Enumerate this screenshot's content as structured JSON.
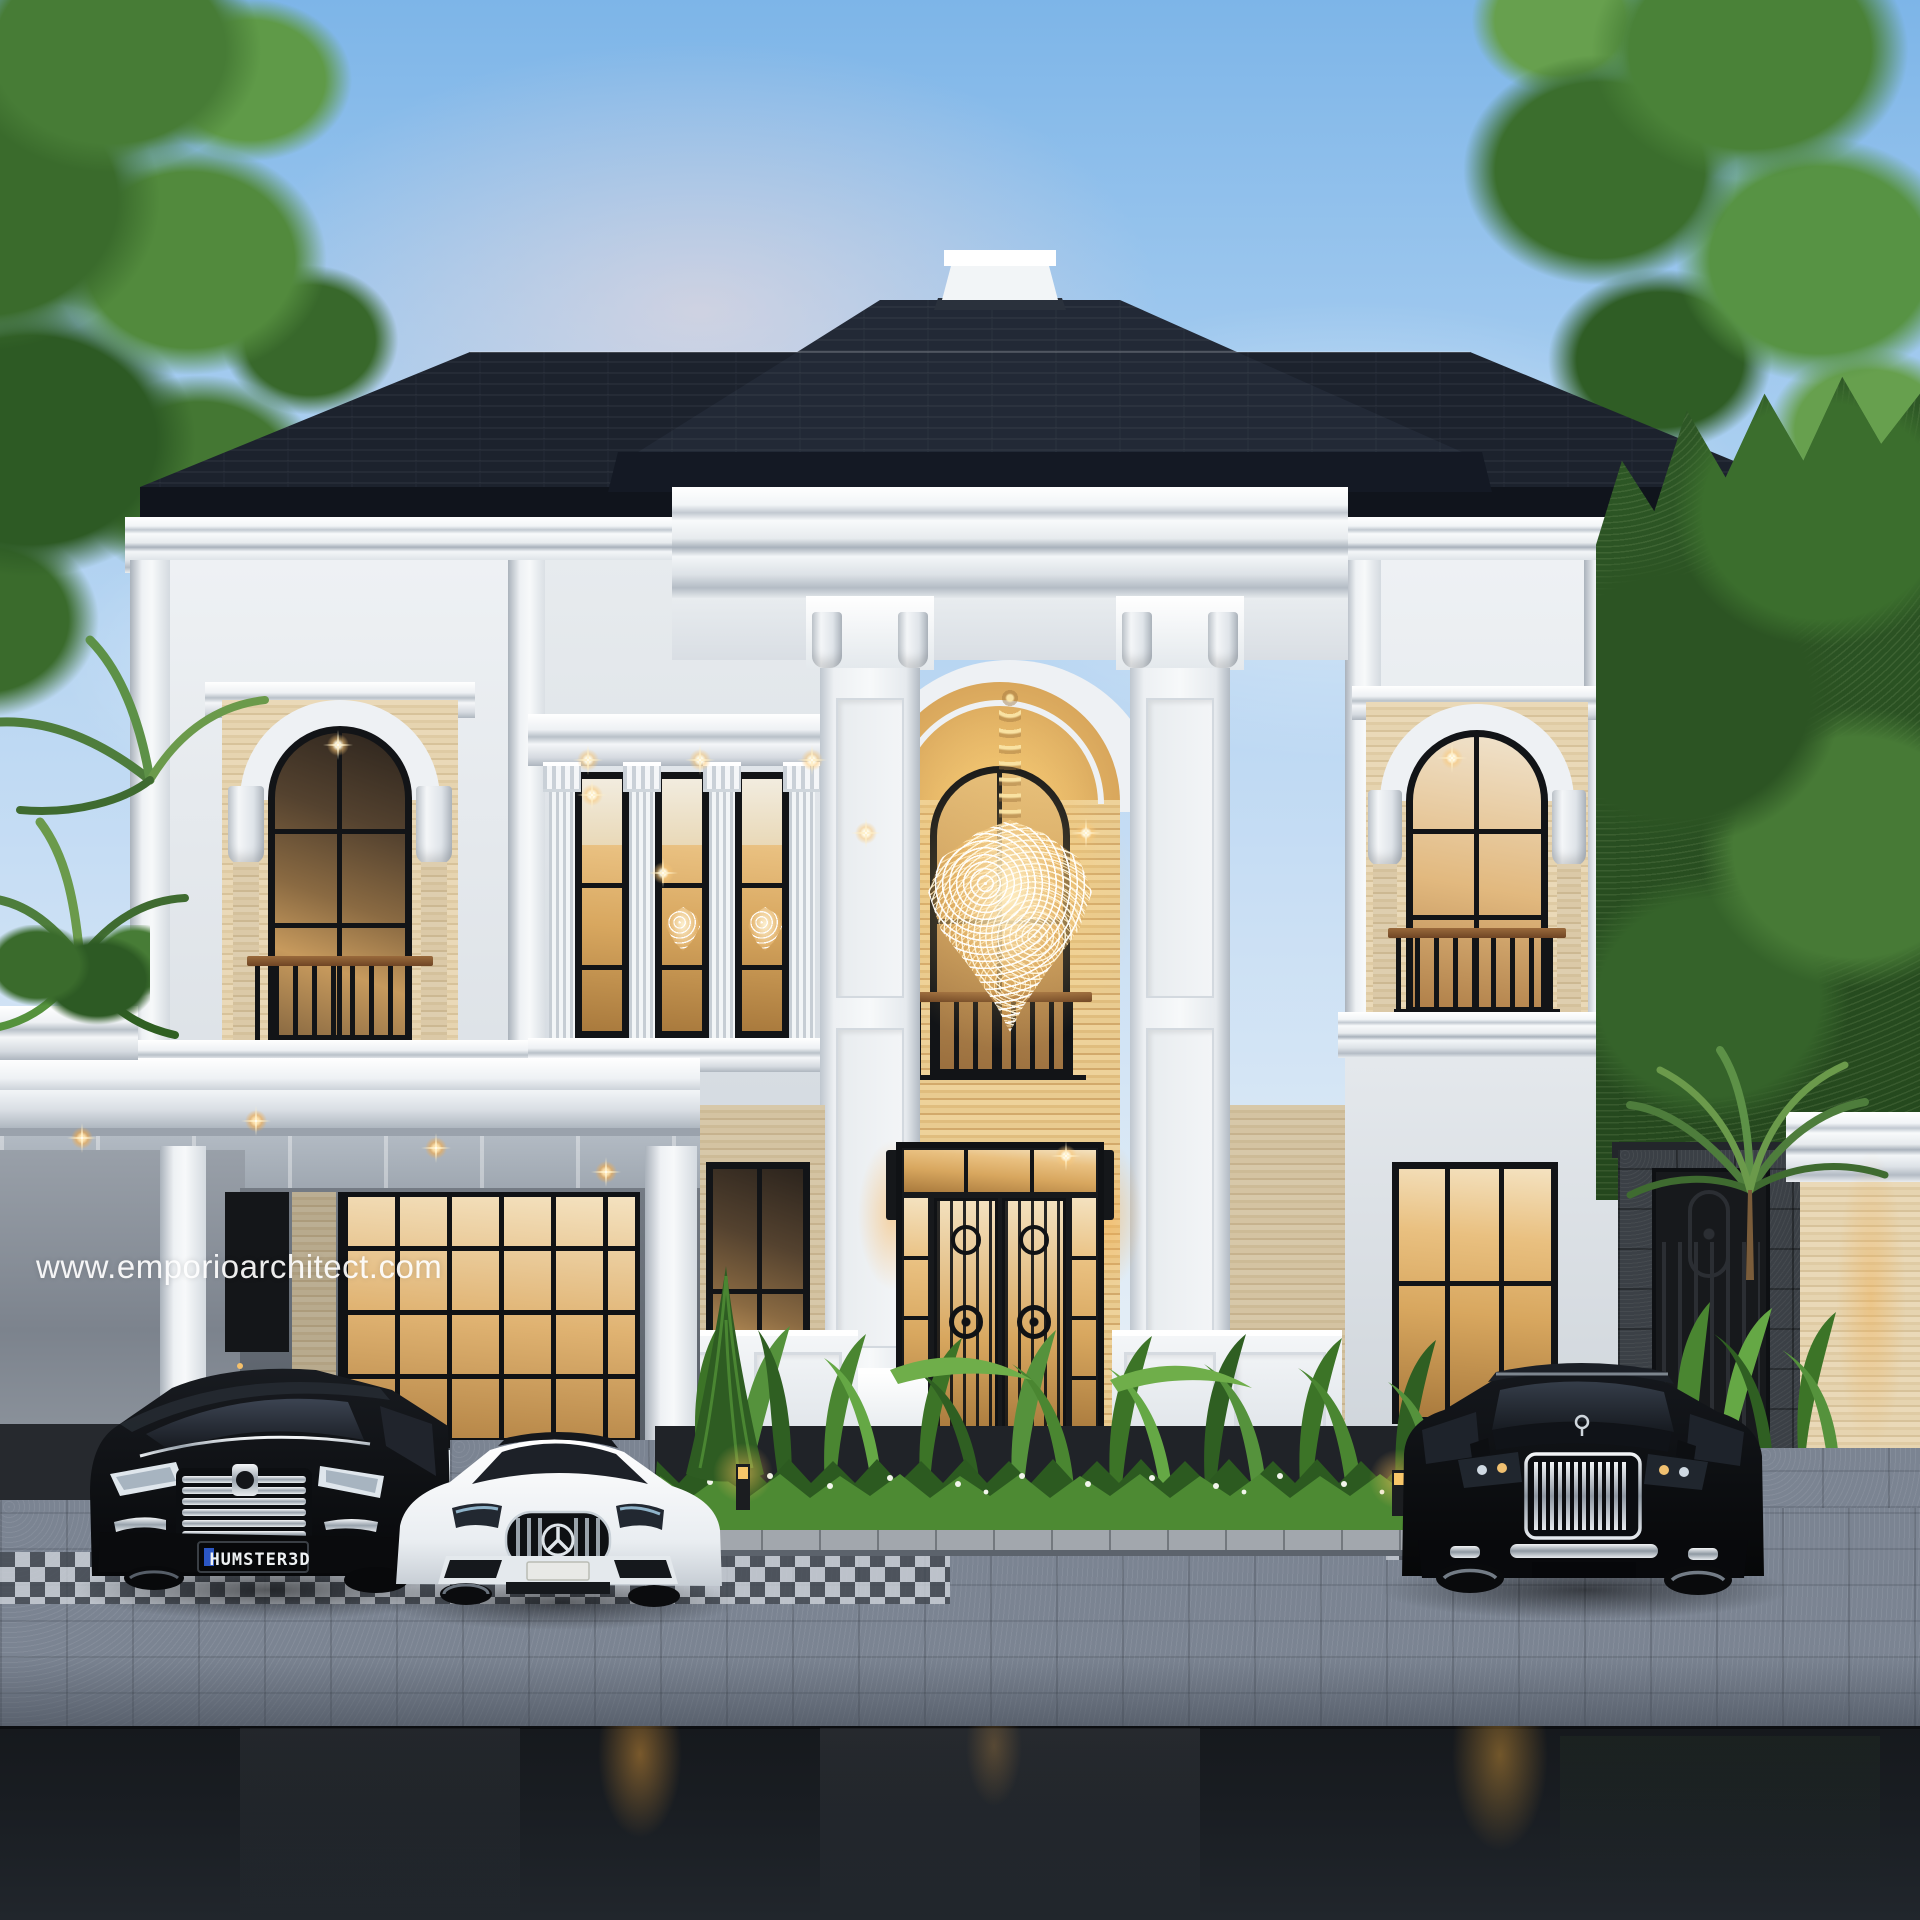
{
  "watermark": {
    "text": "www.emporioarchitect.com"
  },
  "vehicles": {
    "van": {
      "name": "black luxury MPV",
      "license_plate": "HUMSTER3D"
    },
    "sedan": {
      "name": "white sports sedan"
    },
    "suv": {
      "name": "black luxury SUV"
    }
  },
  "palette": {
    "sky-top": "#7db5e8",
    "sky-horizon": "#eef2f4",
    "roof": "#1c222d",
    "roof-fascia": "#10141c",
    "trim-white": "#f2f5f7",
    "wall-light": "#e8ecef",
    "travertine": "#e7d7b4",
    "glass-warm": "#c79a5d",
    "light-amber": "#f0b050",
    "foliage": "#47763a",
    "pavement": "#7b8492",
    "asphalt": "#16191d"
  },
  "scene": {
    "description": "Two-storey classical luxury house exterior render at dusk with grand arched portico, crystal chandelier, carport and three parked cars",
    "elements": [
      "dark hip roof with white finial",
      "white cornices and pilasters",
      "travertine accents",
      "arched balcony windows",
      "wrought-iron entrance door",
      "carport canopy with downlights",
      "tropical garden bed",
      "stone fence with iron gate",
      "wet asphalt road with light reflections"
    ]
  }
}
